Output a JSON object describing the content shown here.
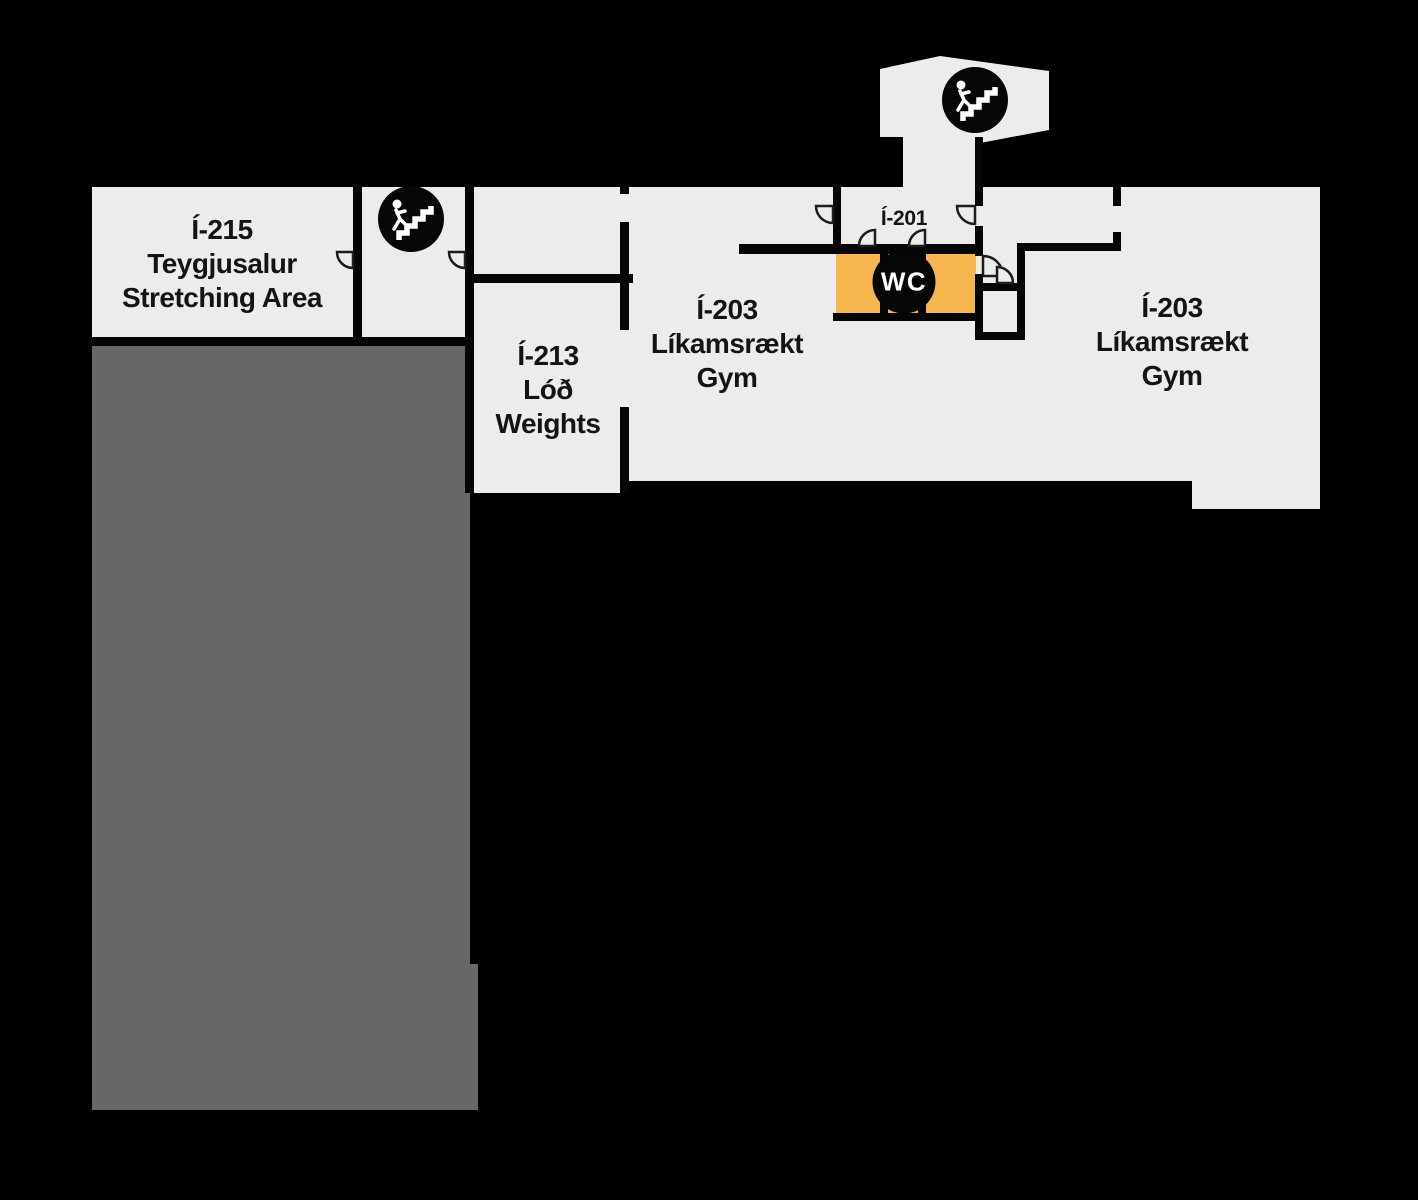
{
  "palette": {
    "background": "#000000",
    "floor": "#ececeb",
    "open_area": "#676767",
    "wall": "#050505",
    "wc_fill": "#f4b64d",
    "icon_bg": "#060606",
    "icon_fg": "#ffffff",
    "label_color": "#141414"
  },
  "rooms": {
    "i215": {
      "label": "Í-215\nTeygjusalur\nStretching Area"
    },
    "i213": {
      "label": "Í-213\nLóð\nWeights"
    },
    "i203_center": {
      "label": "Í-203\nLíkamsrækt\nGym"
    },
    "i203_right": {
      "label": "Í-203\nLíkamsrækt\nGym"
    },
    "i201": {
      "label": "Í-201"
    },
    "wc": {
      "label": "WC"
    }
  },
  "icons": {
    "stairs_tower": "stairs-icon",
    "stairs_main": "stairs-icon",
    "wc_badge": "wc-circle-badge"
  }
}
